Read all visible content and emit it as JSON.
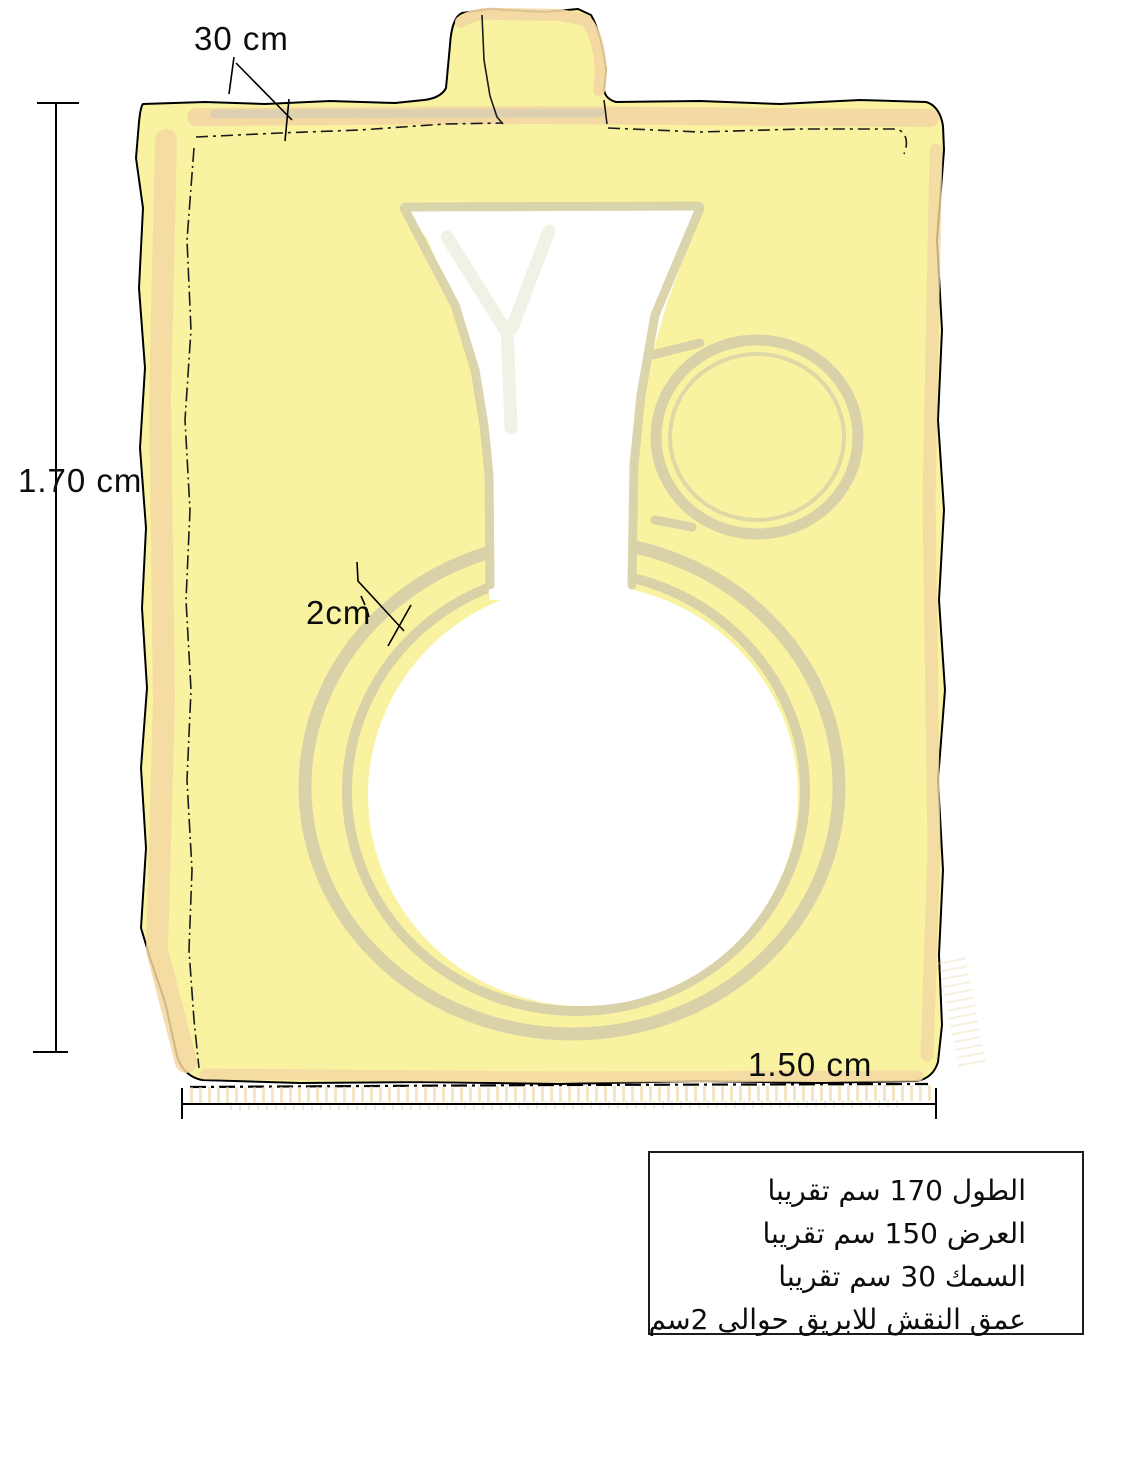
{
  "diagram": {
    "title_hint": "hand-drawn stone slab with engraved jug outline and dimensions",
    "labels": {
      "thickness": "30 cm",
      "height": "1.70 cm",
      "engraving_depth": "2cm",
      "width": "1.50 cm"
    },
    "info_box": {
      "lines": [
        "الطول 170 سم تقريبا",
        "العرض 150 سم تقريبا",
        "السمك 30  سم تقريبا",
        "عمق النقش للابريق حوالى 2سم"
      ]
    },
    "colors": {
      "background": "#ffffff",
      "slab_fill": "#f9f3a1",
      "shading_band": "#f3d7a2",
      "ghost_outline": "#d9d2a8",
      "ink_outline": "#000000",
      "jug_fill": "#ffffff"
    }
  }
}
